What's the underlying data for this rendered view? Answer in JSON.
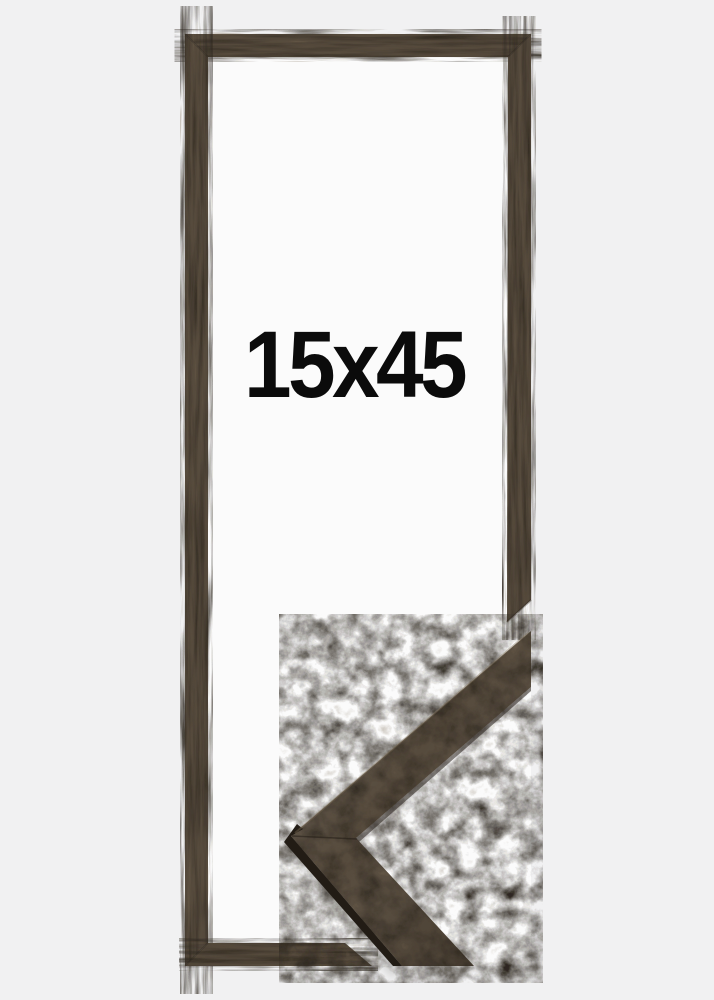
{
  "product": {
    "size_label": "15x45"
  },
  "colors": {
    "background": "#f1f1f2",
    "opening_white": "#fbfbfb",
    "wood_base": "#574b3c",
    "wood_dark_streak": "#2e2820",
    "wood_light_fleck": "#7e6f59",
    "edge_rim": "#221c15",
    "label_text": "#0b0b0b"
  }
}
